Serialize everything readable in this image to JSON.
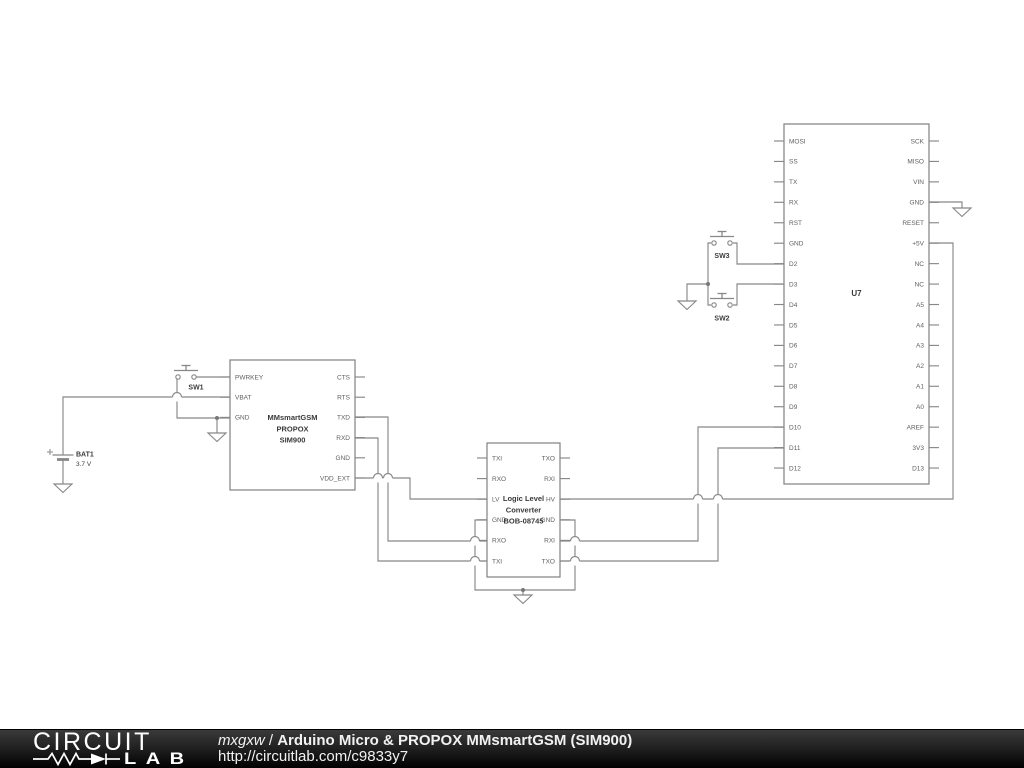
{
  "colors": {
    "background": "#ffffff",
    "wire": "#888888",
    "box_border": "#808080",
    "pin_text": "#5f5f5f",
    "label_text": "#3a3a3a",
    "dot": "#777777",
    "footer_text": "#f2f2f2"
  },
  "schematic": {
    "ics": [
      {
        "name": "arduino-micro-u7",
        "x": 784,
        "y": 124,
        "w": 145,
        "h": 360,
        "ps": 17,
        "sp": 20.44,
        "title": [
          "U7"
        ],
        "title_y": 296,
        "title_size": 8,
        "left": [
          "MOSI",
          "SS",
          "TX",
          "RX",
          "RST",
          "GND",
          "D2",
          "D3",
          "D4",
          "D5",
          "D6",
          "D7",
          "D8",
          "D9",
          "D10",
          "D11",
          "D12"
        ],
        "right": [
          "SCK",
          "MISO",
          "VIN",
          "GND",
          "RESET",
          "+5V",
          "NC",
          "NC",
          "A5",
          "A4",
          "A3",
          "A2",
          "A1",
          "A0",
          "AREF",
          "3V3",
          "D13"
        ]
      },
      {
        "name": "mmsmartgsm-module",
        "x": 230,
        "y": 360,
        "w": 125,
        "h": 130,
        "ps": 17,
        "sp": 20.2,
        "title": [
          "MMsmartGSM",
          "PROPOX",
          "SIM900"
        ],
        "title_y": 420,
        "title_size": 7.5,
        "left": [
          "PWRKEY",
          "VBAT",
          "GND"
        ],
        "right": [
          "CTS",
          "RTS",
          "TXD",
          "RXD",
          "GND",
          "VDD_EXT"
        ]
      },
      {
        "name": "logic-level-converter",
        "x": 487,
        "y": 443,
        "w": 73,
        "h": 134,
        "ps": 15,
        "sp": 20.6,
        "title": [
          "Logic Level",
          "Converter",
          "BOB-08745"
        ],
        "title_y": 501,
        "title_size": 7.5,
        "left": [
          "TXI",
          "RXO",
          "LV",
          "GND",
          "RXO",
          "TXI"
        ],
        "right": [
          "TXO",
          "RXI",
          "HV",
          "GND",
          "RXI",
          "TXO"
        ]
      }
    ],
    "switches": [
      {
        "name": "pushbutton-sw1",
        "ref": "SW1",
        "x": 186,
        "y": 377,
        "ldx": 10,
        "ldy": 12.5
      },
      {
        "name": "pushbutton-sw3",
        "ref": "SW3",
        "x": 722,
        "y": 243,
        "ldx": 0,
        "ldy": 15
      },
      {
        "name": "pushbutton-sw2",
        "ref": "SW2",
        "x": 722,
        "y": 305,
        "ldx": 0,
        "ldy": 15.5
      }
    ],
    "battery": {
      "name": "battery-bat1",
      "ref": "BAT1",
      "value": "3.7 V",
      "x": 63,
      "y": 455
    },
    "wires": [
      [
        [
          63,
          455
        ],
        [
          63,
          397
        ],
        [
          230,
          397
        ]
      ],
      [
        [
          196,
          377
        ],
        [
          230,
          377
        ]
      ],
      [
        [
          177,
          379
        ],
        [
          177,
          418
        ],
        [
          230,
          418
        ]
      ],
      [
        [
          217,
          418
        ],
        [
          217,
          433
        ]
      ],
      [
        [
          63,
          460
        ],
        [
          63,
          484
        ]
      ],
      [
        [
          355,
          417
        ],
        [
          388,
          417
        ],
        [
          388,
          541
        ],
        [
          487,
          541
        ]
      ],
      [
        [
          355,
          438
        ],
        [
          378,
          438
        ],
        [
          378,
          561
        ],
        [
          487,
          561
        ]
      ],
      [
        [
          355,
          478
        ],
        [
          410,
          478
        ],
        [
          410,
          499
        ],
        [
          487,
          499
        ]
      ],
      [
        [
          487,
          520
        ],
        [
          475,
          520
        ],
        [
          475,
          590
        ],
        [
          575,
          590
        ],
        [
          575,
          520
        ],
        [
          560,
          520
        ]
      ],
      [
        [
          523,
          590
        ],
        [
          523,
          595
        ]
      ],
      [
        [
          560,
          499
        ],
        [
          953,
          499
        ],
        [
          953,
          243
        ],
        [
          929,
          243
        ]
      ],
      [
        [
          560,
          541
        ],
        [
          698,
          541
        ],
        [
          698,
          427
        ],
        [
          784,
          427
        ]
      ],
      [
        [
          560,
          561
        ],
        [
          718,
          561
        ],
        [
          718,
          448
        ],
        [
          784,
          448
        ]
      ],
      [
        [
          733,
          243
        ],
        [
          737,
          243
        ],
        [
          737,
          264
        ],
        [
          784,
          264
        ]
      ],
      [
        [
          733,
          305
        ],
        [
          737,
          305
        ],
        [
          737,
          284
        ],
        [
          784,
          284
        ]
      ],
      [
        [
          711,
          243
        ],
        [
          708,
          243
        ],
        [
          708,
          305
        ],
        [
          711,
          305
        ]
      ],
      [
        [
          708,
          284
        ],
        [
          687,
          284
        ],
        [
          687,
          301
        ]
      ],
      [
        [
          929,
          202
        ],
        [
          962,
          202
        ],
        [
          962,
          208
        ]
      ]
    ],
    "hops": [
      [
        177,
        397
      ],
      [
        378,
        478
      ],
      [
        388,
        478
      ],
      [
        475,
        541
      ],
      [
        475,
        561
      ],
      [
        575,
        541
      ],
      [
        575,
        561
      ],
      [
        698,
        499
      ],
      [
        718,
        499
      ]
    ],
    "dots": [
      [
        217,
        418
      ],
      [
        708,
        284
      ],
      [
        523,
        590
      ]
    ],
    "grounds": [
      [
        63,
        484
      ],
      [
        217,
        433
      ],
      [
        687,
        301
      ],
      [
        962,
        208
      ],
      [
        523,
        595
      ]
    ]
  },
  "footer": {
    "author": "mxgxw",
    "separator": " / ",
    "title": "Arduino Micro & PROPOX MMsmartGSM (SIM900)",
    "url": "http://circuitlab.com/c9833y7",
    "logo_top": "CIRCUIT",
    "logo_bottom": "LAB"
  }
}
